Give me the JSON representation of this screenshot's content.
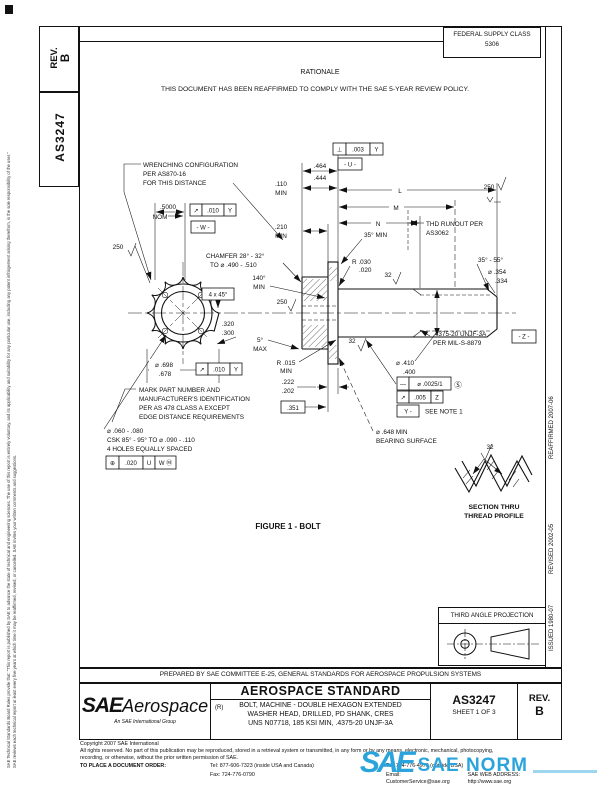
{
  "doc": {
    "corner_rev_label": "REV.",
    "corner_rev_value": "B",
    "corner_doc_number": "AS3247"
  },
  "margins": {
    "disclaimer_1": "SAE Technical Standards Board Rules provide that: \"This report is published by SAE to advance the state of technical and engineering sciences. The use of this report is entirely voluntary, and its applicability and suitability for any particular use, including any patent infringement arising therefrom, is the sole responsibility of the user.\"",
    "disclaimer_2": "SAE reviews each technical report at least every five years at which time it may be reaffirmed, revised, or cancelled. SAE invites your written comments and suggestions.",
    "reaffirmed": "REAFFIRMED 2007-06",
    "revised": "REVISED 2002-05",
    "issued": "ISSUED 1980-07"
  },
  "header": {
    "fsc_title": "FEDERAL SUPPLY CLASS",
    "fsc_code": "5306",
    "rationale_title": "RATIONALE",
    "rationale_body": "THIS DOCUMENT HAS BEEN REAFFIRMED TO COMPLY WITH THE SAE 5-YEAR REVIEW POLICY."
  },
  "figure": {
    "caption": "FIGURE 1 - BOLT",
    "labels": {
      "wr1": "WRENCHING CONFIGURATION",
      "wr2": "PER AS870-16",
      "wr3": "FOR THIS DISTANCE",
      "d5000": ".5000",
      "nom": "NOM",
      "fcfw_s": "↗",
      "fcfw_t": ".010",
      "fcfw_d": "Y",
      "datw": "- W -",
      "fin250a": "250",
      "cham1": "CHAMFER 28° - 32°",
      "cham2": "TO ⌀ .490 - .510",
      "a140a": "140°",
      "a140b": "MIN",
      "csk45": "4 x 45°",
      "d464a": ".464",
      "d464b": ".444",
      "d110a": ".110",
      "d110b": "MIN",
      "d210a": ".210",
      "d210b": "MIN",
      "fcfp_s": "⊥",
      "fcfp_t": ".003",
      "fcfp_d": "Y",
      "datu": "- U -",
      "dl": "L",
      "dm": "M",
      "dn": "N",
      "a35": "35° MIN",
      "ro1": "THD RUNOUT PER",
      "ro2": "AS3062",
      "fin250b": "250",
      "r030a": "R .030",
      "r030b": ".020",
      "fin32a": "32",
      "a3555": "35° - 55°",
      "d354a": "⌀ .354",
      "d354b": ".334",
      "thr1": ".4375-20 UNJF-3A",
      "thr2": "PER MIL-S-8879",
      "datz": "- Z -",
      "fin250c": "250",
      "a5a": "5°",
      "a5b": "MAX",
      "r015a": "R .015",
      "r015b": "MIN",
      "d320a": ".320",
      "d320b": ".300",
      "d698a": "⌀ .698",
      "d698b": ".678",
      "fcfy_s": "↗",
      "fcfy_t": ".010",
      "fcfy_d": "Y",
      "d222a": ".222",
      "d222b": ".202",
      "d351": ".351",
      "fin32b": "32",
      "d410a": "⌀ .410",
      "d410b": ".400",
      "fcfs_s": "—",
      "fcfs_t": "⌀ .0025/1",
      "fcfs_m": "Ⓢ",
      "fcfr_s": "↗",
      "fcfr_t": ".005",
      "fcfr_d": "Z",
      "daty": "Y -",
      "note1": "SEE NOTE 1",
      "brg1": "⌀ .648 MIN",
      "brg2": "BEARING SURFACE",
      "mk1": "MARK PART NUMBER AND",
      "mk2": "MANUFACTURER'S IDENTIFICATION",
      "mk3": "PER AS 478 CLASS A EXCEPT",
      "mk4": "EDGE DISTANCE REQUIREMENTS",
      "ho1": "⌀ .060 - .080",
      "ho2": "CSK 85° - 95° TO ⌀ .090 - .110",
      "ho3": "4 HOLES EQUALLY SPACED",
      "pos_s": "⊕",
      "pos_t": ".020",
      "pos_d1": "U",
      "pos_d2": "W Ⓜ",
      "fin32c": "32",
      "sec1": "SECTION THRU",
      "sec2": "THREAD PROFILE"
    }
  },
  "projection": {
    "title": "THIRD ANGLE PROJECTION"
  },
  "title_block": {
    "prepared_by": "PREPARED BY SAE COMMITTEE E-25, GENERAL STANDARDS FOR AEROSPACE PROPULSION SYSTEMS",
    "logo_main": "SAE",
    "logo_sub": "Aerospace",
    "logo_tag": "An SAE International Group",
    "std_type": "AEROSPACE STANDARD",
    "revision_mark": "(R)",
    "title_1": "BOLT, MACHINE - DOUBLE HEXAGON EXTENDED",
    "title_2": "WASHER HEAD, DRILLED, PD SHANK, CRES",
    "title_3": "UNS N07718, 185 KSI MIN, .4375-20 UNJF-3A",
    "doc_number": "AS3247",
    "sheet": "SHEET 1 OF 3",
    "rev_label": "REV.",
    "rev_value": "B"
  },
  "footer": {
    "copyright": "Copyright 2007 SAE International",
    "rights": "All rights reserved. No part of this publication may be reproduced, stored in a retrieval system or transmitted, in any form or by any means, electronic, mechanical, photocopying, recording, or otherwise, without the prior written permission of SAE.",
    "order_label": "TO PLACE A DOCUMENT ORDER:",
    "tel_inside": "Tel: 877-606-7323 (inside USA and Canada)",
    "tel_outside": "Tel: 724-776-4970 (outside USA)",
    "fax": "Fax: 724-776-0790",
    "email": "Email: CustomerService@sae.org",
    "web": "SAE WEB ADDRESS: http://www.sae.org"
  },
  "watermark": {
    "logo": "SAE",
    "name": "SAE NORM"
  }
}
